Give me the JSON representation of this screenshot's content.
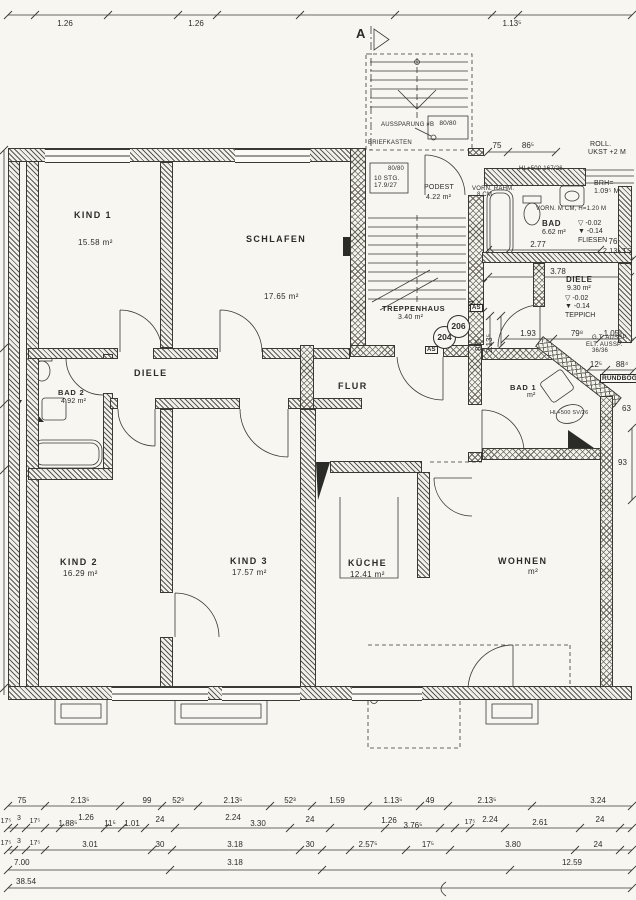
{
  "rooms": {
    "kind1": {
      "name": "KIND 1",
      "area": "15.58 m²"
    },
    "schlafen": {
      "name": "SCHLAFEN",
      "area": "17.65 m²"
    },
    "diele": {
      "name": "DIELE"
    },
    "bad2": {
      "name": "BAD 2",
      "area": "4.92 m²"
    },
    "kind2": {
      "name": "KIND 2",
      "area": "16.29 m²"
    },
    "kind3": {
      "name": "KIND 3",
      "area": "17.57 m²"
    },
    "flur": {
      "name": "FLUR"
    },
    "kueche": {
      "name": "KÜCHE",
      "area": "12.41 m²"
    },
    "wohnen": {
      "name": "WOHNEN",
      "area": "m²"
    },
    "bad1": {
      "name": "BAD 1",
      "area": "m²"
    },
    "bad_og": {
      "name": "BAD",
      "area": "6.62 m²",
      "lvl1": "▽ -0.02",
      "lvl2": "▼ -0.14",
      "finish": "FLIESEN"
    },
    "diele_og": {
      "name": "DIELE",
      "area": "9.30 m²",
      "lvl1": "▽ -0.02",
      "lvl2": "▼ -0.14",
      "finish": "TEPPICH"
    },
    "treppenhaus": {
      "name": "TREPPENHAUS",
      "area": "3.40 m²"
    },
    "podest": {
      "name": "PODEST",
      "area": "4.22 m²"
    }
  },
  "stair": {
    "aussparung": "AUSSPARUNG #B",
    "box": "80/80",
    "box2": "80/80",
    "briefkasten": "BRIEFKASTEN",
    "stg": "10 STG.",
    "stg2": "17.9/27"
  },
  "marker": {
    "section": "A",
    "c204": "204",
    "c206": "206",
    "as1": "AS",
    "as2": "AS"
  },
  "notes": {
    "roll1": "ROLL.",
    "roll2": "UKST +2 M",
    "hl1": "HL+500 167/26",
    "vorn1": "VORN. RAHM.",
    "vorn1b": "8 CM",
    "brh1": "BRH=",
    "brh2": "1.09⁵ M",
    "vorn2": "VORN. M CM, H=1.20 M",
    "ts": "2.13⁵ TS",
    "gt": "G.T. AUSSP.",
    "elt": "ELT. AUSSP.",
    "elt2": "36/36",
    "rundbog": "RUNDBOG.",
    "hlsv": "HL+500 SV/26"
  },
  "dims": {
    "top": [
      "1.26",
      "1.26",
      "1.13⁵"
    ],
    "tr": [
      "75",
      "86⁵"
    ],
    "b277": "2.77",
    "b76": "76",
    "d378": "3.78",
    "d193": "1.93",
    "d798": "79⁸",
    "d1056": "1.05⁶",
    "v94": "94",
    "v885": "88⁵",
    "v2135": "2.13⁵",
    "d125": "12⁵",
    "d884": "88⁴",
    "d93": "93",
    "d63": "63",
    "b1": [
      "75",
      "2.13⁵",
      "99",
      "52³",
      "2.13⁵",
      "52³",
      "1.59",
      "1.13⁵",
      "49",
      "2.13⁵",
      "3.24"
    ],
    "b2": [
      "17⁵",
      "3",
      "17⁵",
      "1.88⁵",
      "1.26",
      "11⁵",
      "1.01",
      "24",
      "2.24",
      "3.30",
      "24",
      "1.26",
      "3.76⁵",
      "17⁵",
      "2.24",
      "2.61",
      "24"
    ],
    "b3": [
      "17⁵",
      "3",
      "17⁵",
      "3.01",
      "30",
      "3.18",
      "30",
      "2.57⁵",
      "17⁵",
      "3.80",
      "24"
    ],
    "b4": [
      "7.00",
      "3.18",
      "12.59"
    ],
    "b5": [
      "38.54"
    ]
  }
}
